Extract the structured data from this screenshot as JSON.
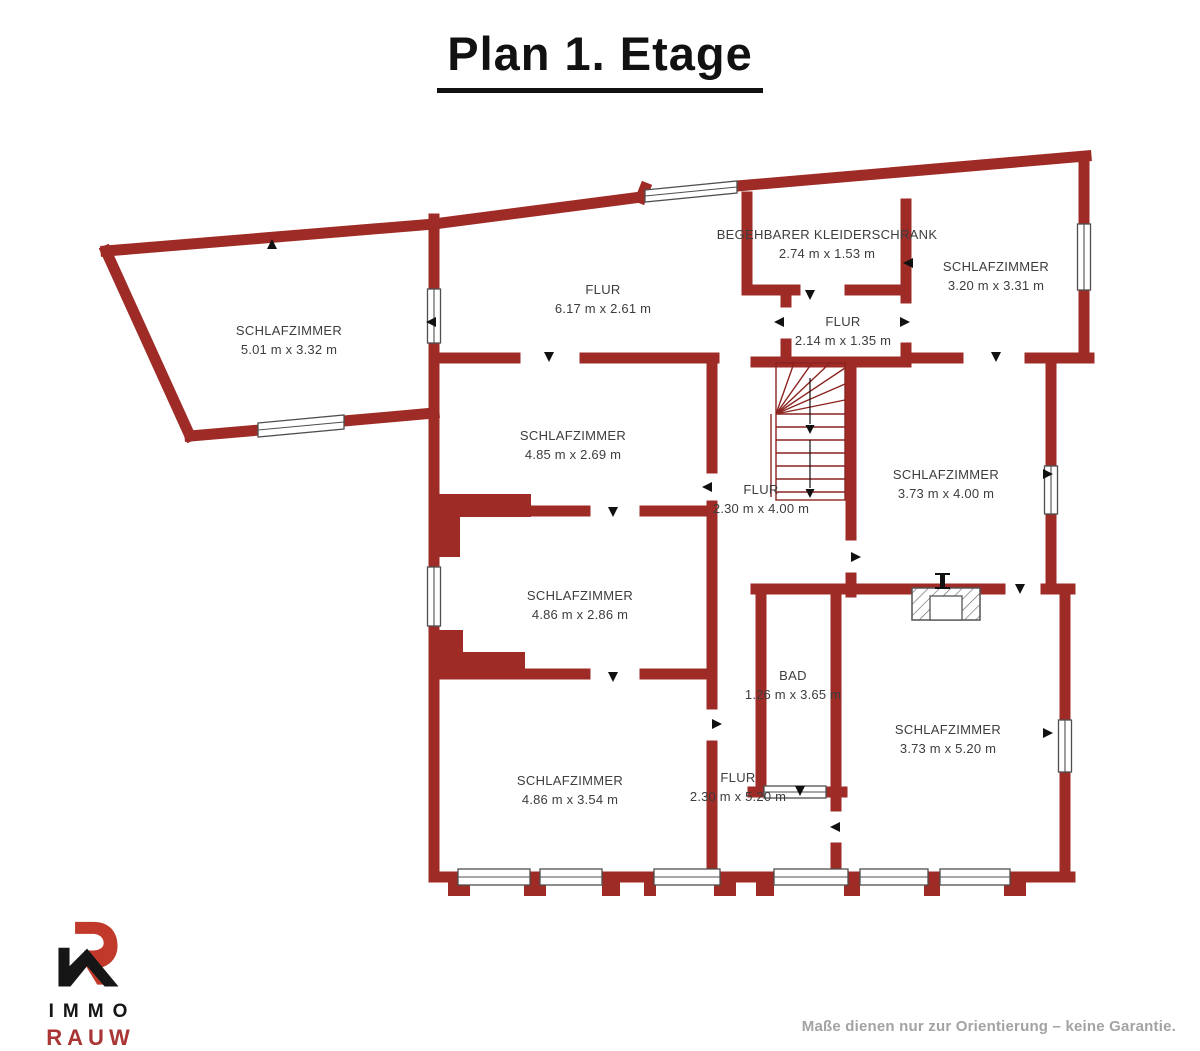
{
  "title": "Plan 1. Etage",
  "disclaimer": "Maße dienen nur zur Orientierung – keine Garantie.",
  "logo": {
    "immo": "IMMO",
    "rauw": "RAUW"
  },
  "colors": {
    "wall": "#9e2b26",
    "ink": "#111111",
    "label": "#3d3d3d",
    "accent": "#a93535",
    "muted": "#a3a3a3"
  },
  "rooms": [
    {
      "name": "SCHLAFZIMMER",
      "dims": "5.01 m x 3.32 m"
    },
    {
      "name": "FLUR",
      "dims": "6.17 m x 2.61 m"
    },
    {
      "name": "BEGEHBARER KLEIDERSCHRANK",
      "dims": "2.74 m x 1.53 m"
    },
    {
      "name": "SCHLAFZIMMER",
      "dims": "3.20 m x 3.31 m"
    },
    {
      "name": "FLUR",
      "dims": "2.14 m x 1.35 m"
    },
    {
      "name": "SCHLAFZIMMER",
      "dims": "4.85 m x 2.69 m"
    },
    {
      "name": "FLUR",
      "dims": "2.30 m x 4.00 m"
    },
    {
      "name": "SCHLAFZIMMER",
      "dims": "3.73 m x 4.00 m"
    },
    {
      "name": "SCHLAFZIMMER",
      "dims": "4.86 m x 2.86 m"
    },
    {
      "name": "BAD",
      "dims": "1.26 m x 3.65 m"
    },
    {
      "name": "SCHLAFZIMMER",
      "dims": "3.73 m x 5.20 m"
    },
    {
      "name": "SCHLAFZIMMER",
      "dims": "4.86 m x 3.54 m"
    },
    {
      "name": "FLUR",
      "dims": "2.30 m x 5.20 m"
    }
  ]
}
